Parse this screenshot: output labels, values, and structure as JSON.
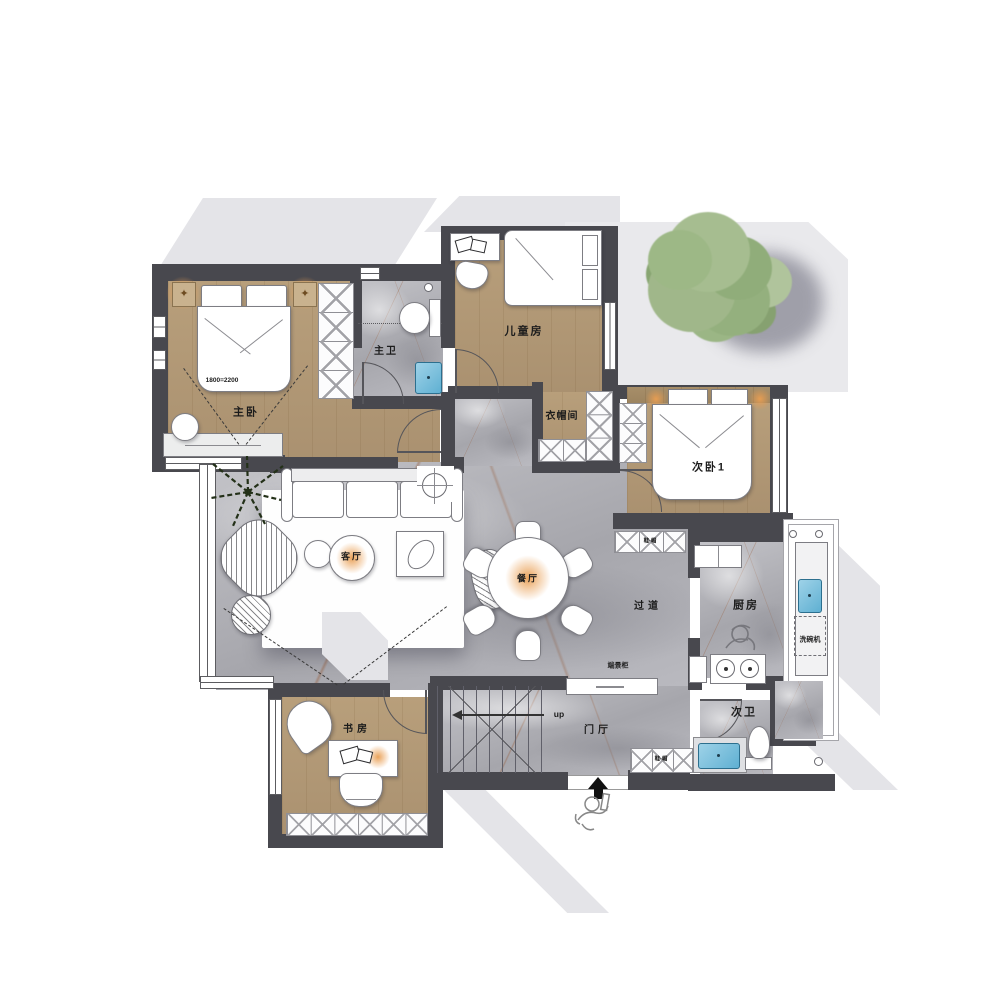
{
  "title": "residential-floor-plan",
  "rooms": [
    {
      "id": "master-bedroom",
      "label": "主卧"
    },
    {
      "id": "master-bath",
      "label": "主卫"
    },
    {
      "id": "kids-room",
      "label": "儿童房"
    },
    {
      "id": "cloakroom",
      "label": "衣帽间"
    },
    {
      "id": "bedroom-2",
      "label": "次卧1"
    },
    {
      "id": "living-room",
      "label": "客厅"
    },
    {
      "id": "dining-room",
      "label": "餐厅"
    },
    {
      "id": "hallway",
      "label": "过道"
    },
    {
      "id": "kitchen",
      "label": "厨房"
    },
    {
      "id": "study",
      "label": "书房"
    },
    {
      "id": "foyer",
      "label": "门厅"
    },
    {
      "id": "bath-2",
      "label": "次卫"
    }
  ],
  "annotations": {
    "bed_size": "1800=2200",
    "stairs_up": "up",
    "dishwasher": "洗碗机",
    "console_cabinet": "端景柜",
    "shoe_cabinet_bedroom2": "鞋·帽",
    "shoe_cabinet_foyer": "鞋·帽"
  },
  "icons": {
    "nightstand_ornament": "✦"
  },
  "palette": {
    "wall": "#48484e",
    "wood_floor": "#b09773",
    "marble_floor": "#b4b4b9",
    "decor_gray": "#e4e4e8",
    "rug": "#ffffff",
    "sink_blue": "#7cc0dd",
    "lamp_glow": "#e99e52",
    "tree_foliage": "#9db886",
    "tree_shadow": "#8d8d99"
  }
}
